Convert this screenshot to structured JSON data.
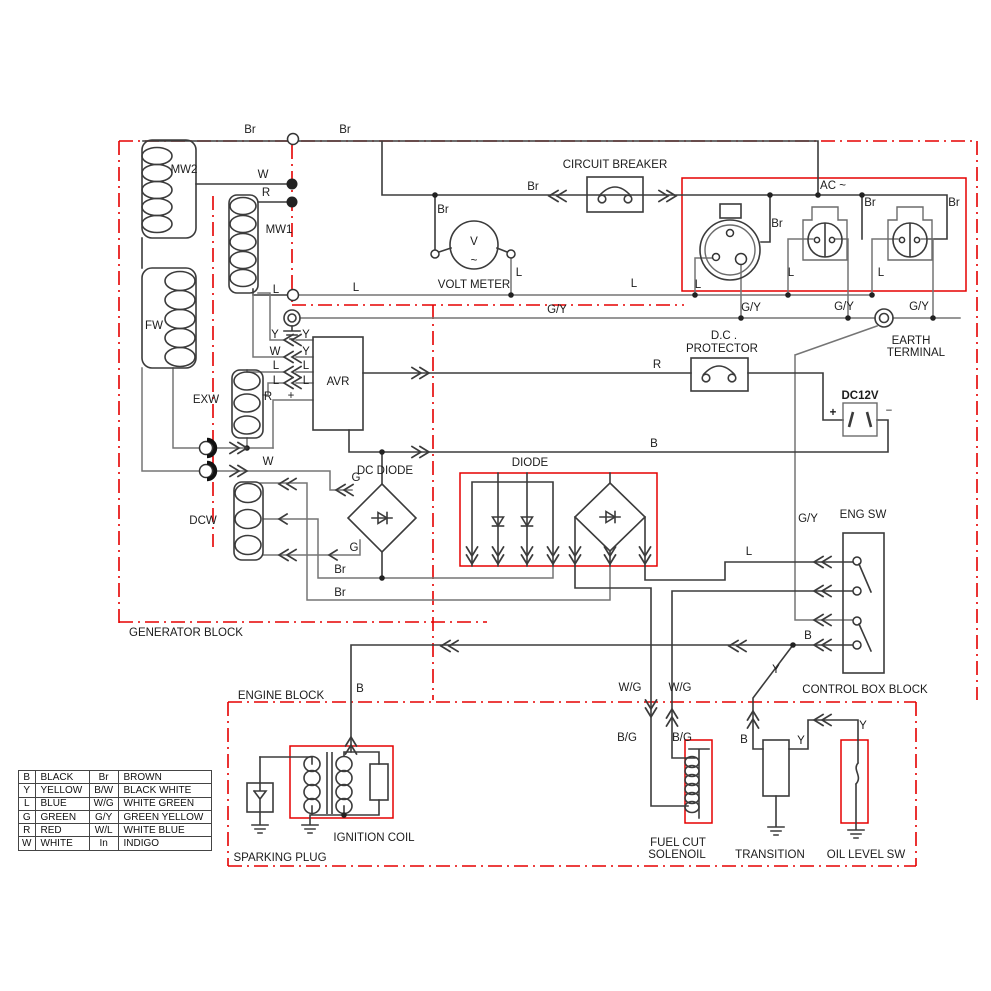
{
  "palette": {
    "border_red": "#e50000",
    "wire_dark": "#3b3b3b",
    "wire_gray": "#757575"
  },
  "legend": {
    "rows": [
      [
        "B",
        "BLACK",
        "Br",
        "BROWN"
      ],
      [
        "Y",
        "YELLOW",
        "B/W",
        "BLACK WHITE"
      ],
      [
        "L",
        "BLUE",
        "W/G",
        "WHITE GREEN"
      ],
      [
        "G",
        "GREEN",
        "G/Y",
        "GREEN YELLOW"
      ],
      [
        "R",
        "RED",
        "W/L",
        "WHITE BLUE"
      ],
      [
        "W",
        "WHITE",
        "In",
        "INDIGO"
      ]
    ]
  },
  "labels": [
    {
      "t": "MW2",
      "x": 184,
      "y": 170,
      "n": "label-mw2"
    },
    {
      "t": "MW1",
      "x": 279,
      "y": 230,
      "n": "label-mw1"
    },
    {
      "t": "FW",
      "x": 154,
      "y": 326,
      "n": "label-fw"
    },
    {
      "t": "EXW",
      "x": 206,
      "y": 400,
      "n": "label-exw"
    },
    {
      "t": "DCW",
      "x": 203,
      "y": 521,
      "n": "label-dcw"
    },
    {
      "t": "AVR",
      "x": 338,
      "y": 382,
      "s": 20,
      "n": "label-avr"
    },
    {
      "t": "V",
      "x": 474,
      "y": 242,
      "s": 27,
      "n": "volt-meter-glyph"
    },
    {
      "t": "~",
      "x": 474,
      "y": 261,
      "s": 16,
      "n": "volt-meter-ac-glyph"
    },
    {
      "t": "VOLT METER",
      "x": 474,
      "y": 285,
      "n": "label-volt-meter"
    },
    {
      "t": "CIRCUIT BREAKER",
      "x": 615,
      "y": 165,
      "n": "label-circuit-breaker"
    },
    {
      "t": "AC ~",
      "x": 833,
      "y": 186,
      "n": "label-ac"
    },
    {
      "t": "D.C .",
      "x": 724,
      "y": 336,
      "n": "label-dc-protector-1"
    },
    {
      "t": "PROTECTOR",
      "x": 722,
      "y": 349,
      "n": "label-dc-protector-2"
    },
    {
      "t": "EARTH",
      "x": 911,
      "y": 341,
      "n": "label-earth-1"
    },
    {
      "t": "TERMINAL",
      "x": 916,
      "y": 353,
      "n": "label-earth-2"
    },
    {
      "t": "DC12V",
      "x": 860,
      "y": 396,
      "b": 1,
      "n": "label-dc12v"
    },
    {
      "t": "+",
      "x": 833,
      "y": 413,
      "s": 15,
      "b": 1,
      "n": "label-plus"
    },
    {
      "t": "−",
      "x": 889,
      "y": 411,
      "s": 15,
      "n": "label-minus"
    },
    {
      "t": "DC DIODE",
      "x": 385,
      "y": 471,
      "n": "label-dc-diode"
    },
    {
      "t": "DIODE",
      "x": 530,
      "y": 463,
      "n": "label-diode"
    },
    {
      "t": "ENG SW",
      "x": 863,
      "y": 515,
      "n": "label-eng-sw"
    },
    {
      "t": "IGNITION COIL",
      "x": 374,
      "y": 838,
      "n": "label-ignition-coil"
    },
    {
      "t": "SPARKING PLUG",
      "x": 280,
      "y": 858,
      "n": "label-sparking-plug"
    },
    {
      "t": "FUEL CUT",
      "x": 678,
      "y": 843,
      "n": "label-fuel-cut-1"
    },
    {
      "t": "SOLENOIL",
      "x": 677,
      "y": 855,
      "n": "label-fuel-cut-2"
    },
    {
      "t": "TRANSITION",
      "x": 770,
      "y": 855,
      "n": "label-transition"
    },
    {
      "t": "OIL LEVEL SW",
      "x": 866,
      "y": 855,
      "n": "label-oil-level-sw"
    },
    {
      "t": "GENERATOR BLOCK",
      "x": 186,
      "y": 633,
      "n": "block-label-generator"
    },
    {
      "t": "ENGINE BLOCK",
      "x": 281,
      "y": 696,
      "n": "block-label-engine"
    },
    {
      "t": "CONTROL BOX BLOCK",
      "x": 865,
      "y": 690,
      "n": "block-label-control-box"
    },
    {
      "t": "Br",
      "x": 250,
      "y": 130,
      "n": "wire-label"
    },
    {
      "t": "Br",
      "x": 345,
      "y": 130,
      "n": "wire-label"
    },
    {
      "t": "Br",
      "x": 443,
      "y": 210,
      "n": "wire-label"
    },
    {
      "t": "Br",
      "x": 533,
      "y": 187,
      "n": "wire-label"
    },
    {
      "t": "Br",
      "x": 777,
      "y": 224,
      "n": "wire-label"
    },
    {
      "t": "Br",
      "x": 870,
      "y": 203,
      "n": "wire-label"
    },
    {
      "t": "Br",
      "x": 954,
      "y": 203,
      "n": "wire-label"
    },
    {
      "t": "W",
      "x": 263,
      "y": 175,
      "n": "wire-label"
    },
    {
      "t": "R",
      "x": 266,
      "y": 193,
      "n": "wire-label"
    },
    {
      "t": "L",
      "x": 276,
      "y": 290,
      "n": "wire-label"
    },
    {
      "t": "L",
      "x": 356,
      "y": 288,
      "n": "wire-label"
    },
    {
      "t": "L",
      "x": 519,
      "y": 273,
      "n": "wire-label"
    },
    {
      "t": "L",
      "x": 634,
      "y": 284,
      "n": "wire-label"
    },
    {
      "t": "L",
      "x": 698,
      "y": 285,
      "n": "wire-label"
    },
    {
      "t": "L",
      "x": 791,
      "y": 273,
      "n": "wire-label"
    },
    {
      "t": "L",
      "x": 881,
      "y": 273,
      "n": "wire-label"
    },
    {
      "t": "G/Y",
      "x": 557,
      "y": 310,
      "n": "wire-label"
    },
    {
      "t": "G/Y",
      "x": 751,
      "y": 308,
      "n": "wire-label"
    },
    {
      "t": "G/Y",
      "x": 844,
      "y": 307,
      "n": "wire-label"
    },
    {
      "t": "G/Y",
      "x": 919,
      "y": 307,
      "n": "wire-label"
    },
    {
      "t": "G/Y",
      "x": 808,
      "y": 519,
      "n": "wire-label"
    },
    {
      "t": "Y",
      "x": 275,
      "y": 335,
      "n": "wire-label"
    },
    {
      "t": "Y",
      "x": 306,
      "y": 335,
      "n": "wire-label"
    },
    {
      "t": "W",
      "x": 275,
      "y": 352,
      "n": "wire-label"
    },
    {
      "t": "Y",
      "x": 306,
      "y": 352,
      "n": "wire-label"
    },
    {
      "t": "L",
      "x": 276,
      "y": 366,
      "n": "wire-label"
    },
    {
      "t": "L",
      "x": 306,
      "y": 366,
      "n": "wire-label"
    },
    {
      "t": "L",
      "x": 276,
      "y": 381,
      "n": "wire-label"
    },
    {
      "t": "L",
      "x": 306,
      "y": 381,
      "n": "wire-label"
    },
    {
      "t": "R",
      "x": 268,
      "y": 397,
      "n": "wire-label"
    },
    {
      "t": "+",
      "x": 291,
      "y": 396,
      "s": 14,
      "n": "wire-label"
    },
    {
      "t": "W",
      "x": 268,
      "y": 462,
      "n": "wire-label"
    },
    {
      "t": "G",
      "x": 356,
      "y": 478,
      "n": "wire-label"
    },
    {
      "t": "G",
      "x": 354,
      "y": 548,
      "n": "wire-label"
    },
    {
      "t": "Br",
      "x": 340,
      "y": 570,
      "n": "wire-label"
    },
    {
      "t": "Br",
      "x": 340,
      "y": 593,
      "n": "wire-label"
    },
    {
      "t": "R",
      "x": 657,
      "y": 365,
      "n": "wire-label"
    },
    {
      "t": "B",
      "x": 654,
      "y": 444,
      "n": "wire-label"
    },
    {
      "t": "L",
      "x": 749,
      "y": 552,
      "n": "wire-label"
    },
    {
      "t": "B",
      "x": 808,
      "y": 636,
      "n": "wire-label"
    },
    {
      "t": "Y",
      "x": 776,
      "y": 670,
      "n": "wire-label"
    },
    {
      "t": "B",
      "x": 360,
      "y": 689,
      "n": "wire-label"
    },
    {
      "t": "W/G",
      "x": 630,
      "y": 688,
      "n": "wire-label"
    },
    {
      "t": "W/G",
      "x": 680,
      "y": 688,
      "n": "wire-label"
    },
    {
      "t": "B/G",
      "x": 627,
      "y": 738,
      "n": "wire-label"
    },
    {
      "t": "B/G",
      "x": 682,
      "y": 738,
      "n": "wire-label"
    },
    {
      "t": "B",
      "x": 744,
      "y": 740,
      "n": "wire-label"
    },
    {
      "t": "Y",
      "x": 801,
      "y": 741,
      "n": "wire-label"
    },
    {
      "t": "Y",
      "x": 863,
      "y": 726,
      "n": "wire-label"
    }
  ]
}
